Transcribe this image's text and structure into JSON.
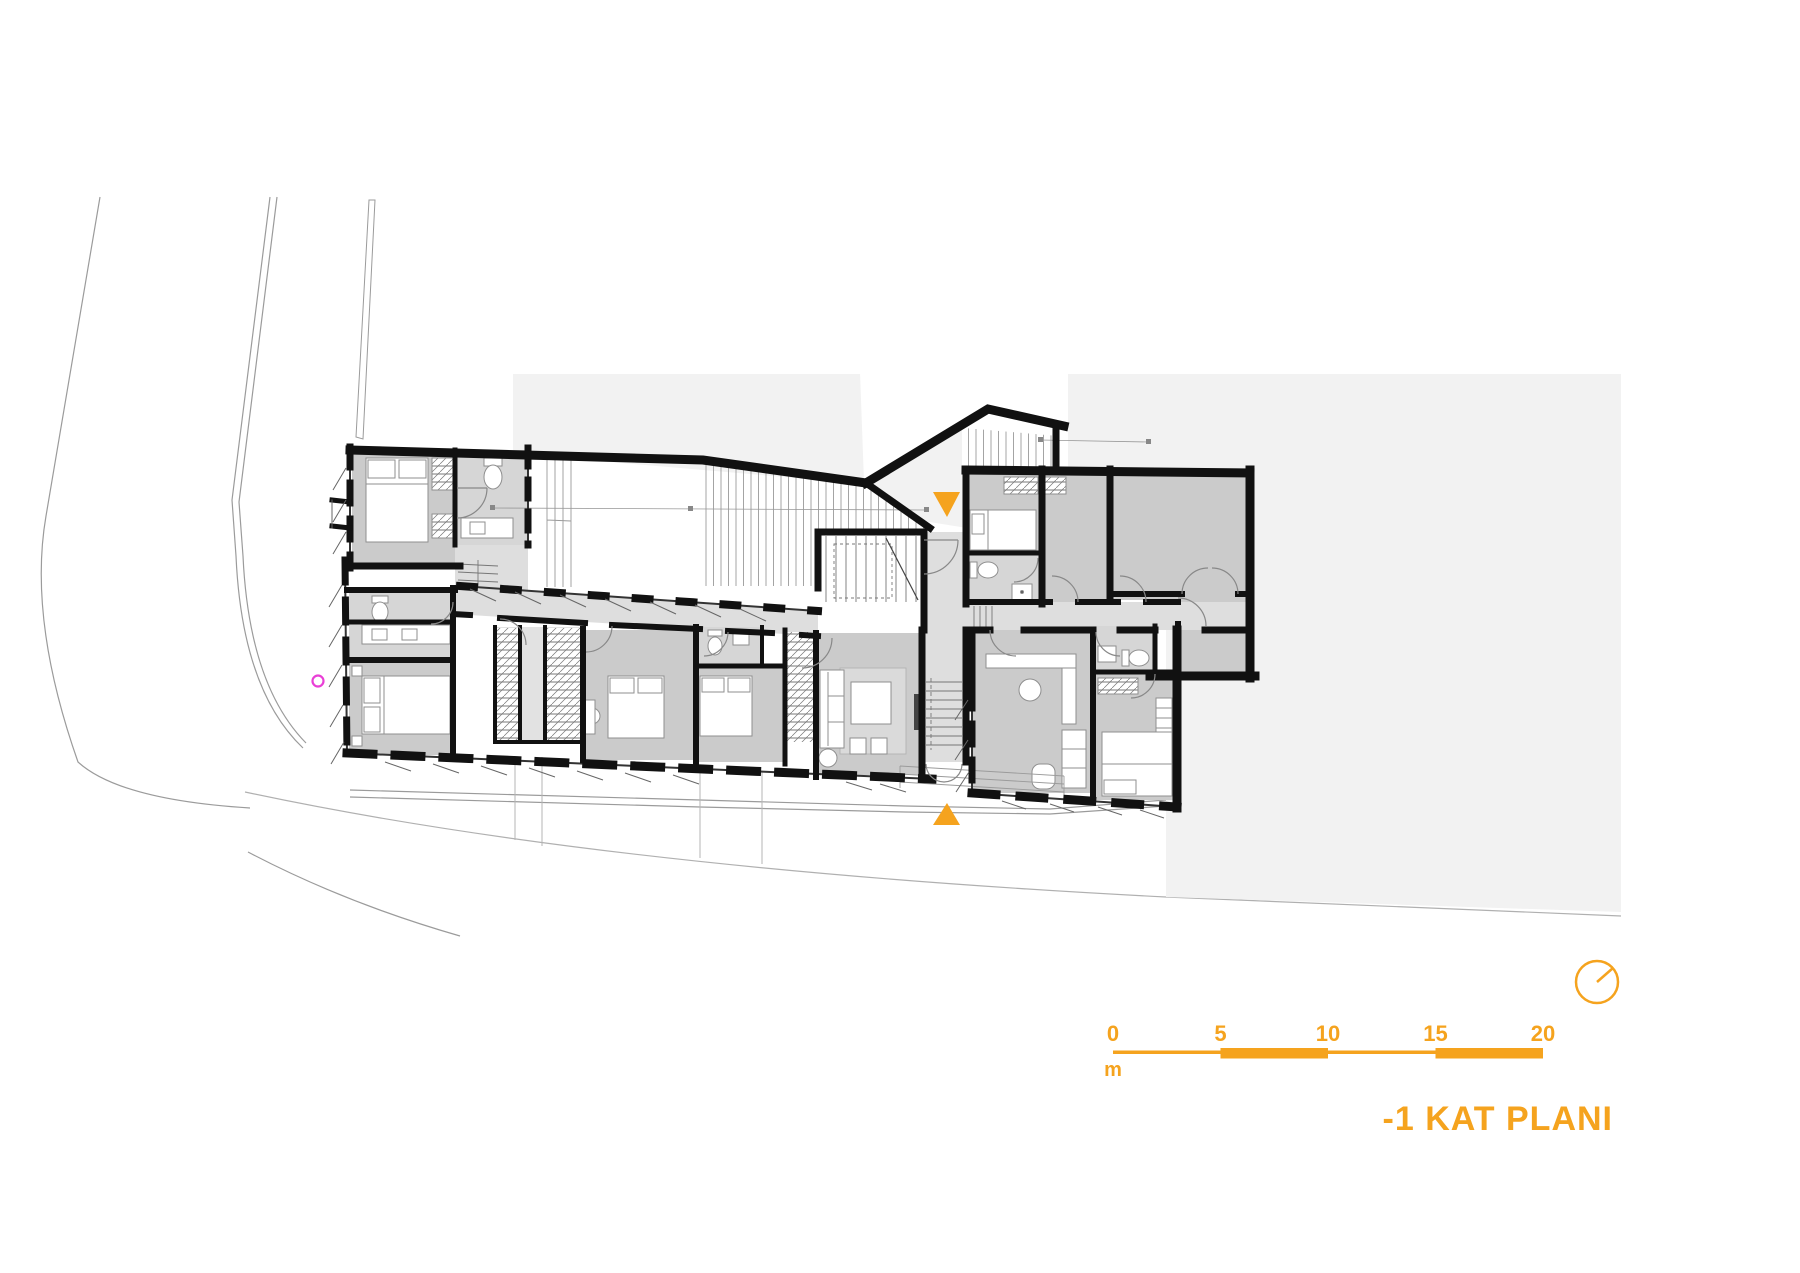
{
  "title": "-1 KAT PLANI",
  "scalebar": {
    "labels": [
      "0",
      "5",
      "10",
      "15",
      "20"
    ],
    "unit": "m"
  },
  "markers": {
    "entrance_top": "entrance-arrow-down",
    "entrance_bottom": "entrance-arrow-up",
    "north": "north-indicator",
    "survey_point": "survey-point"
  },
  "colors": {
    "accent": "#F5A31E",
    "magenta": "#E93FD6",
    "wall": "#111111",
    "room_fill": "#cbcbcb",
    "service_fill": "#d6d6d6",
    "corridor_fill": "#dedede",
    "site_backdrop": "#f2f2f2"
  }
}
